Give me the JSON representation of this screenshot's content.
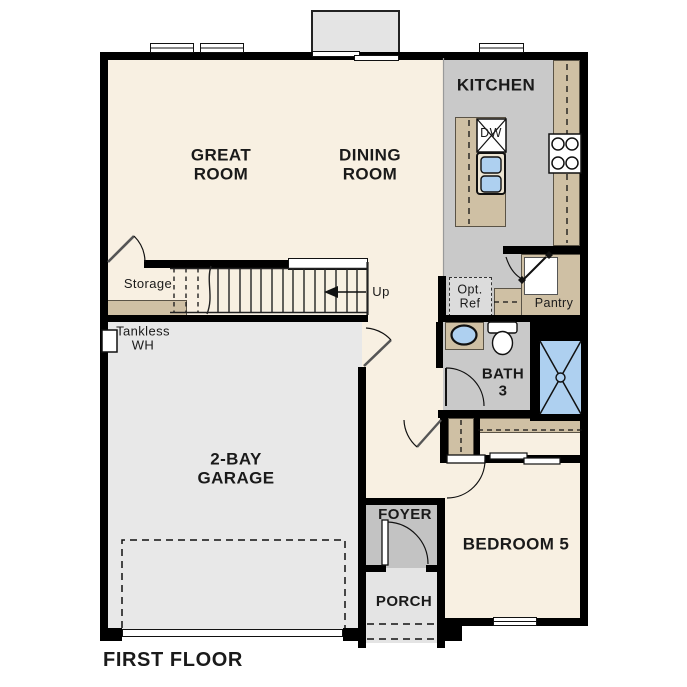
{
  "plan": {
    "floor_title": "FIRST FLOOR",
    "rooms": {
      "great_room": [
        "GREAT",
        "ROOM"
      ],
      "dining_room": [
        "DINING",
        "ROOM"
      ],
      "kitchen": [
        "KITCHEN"
      ],
      "garage": [
        "2-BAY",
        "GARAGE"
      ],
      "bedroom5": [
        "BEDROOM 5"
      ],
      "bath3": [
        "BATH",
        "3"
      ],
      "foyer": [
        "FOYER"
      ],
      "porch": [
        "PORCH"
      ],
      "storage": [
        "Storage"
      ],
      "pantry": [
        "Pantry"
      ]
    },
    "annotations": {
      "up": "Up",
      "tankless_wh": [
        "Tankless",
        "WH"
      ],
      "opt_ref": [
        "Opt.",
        "Ref"
      ],
      "dishwasher": "DW"
    },
    "colors": {
      "wall": "#000000",
      "floor_main": "#f8f0e2",
      "floor_wet": "#c9c9c9",
      "floor_garage": "#e8e8e8",
      "floor_porch": "#e4e4e4",
      "cabinet_tan": "#cfc0a4",
      "fixture_blue": "#aed0f0",
      "text": "#1a1a1a"
    }
  }
}
